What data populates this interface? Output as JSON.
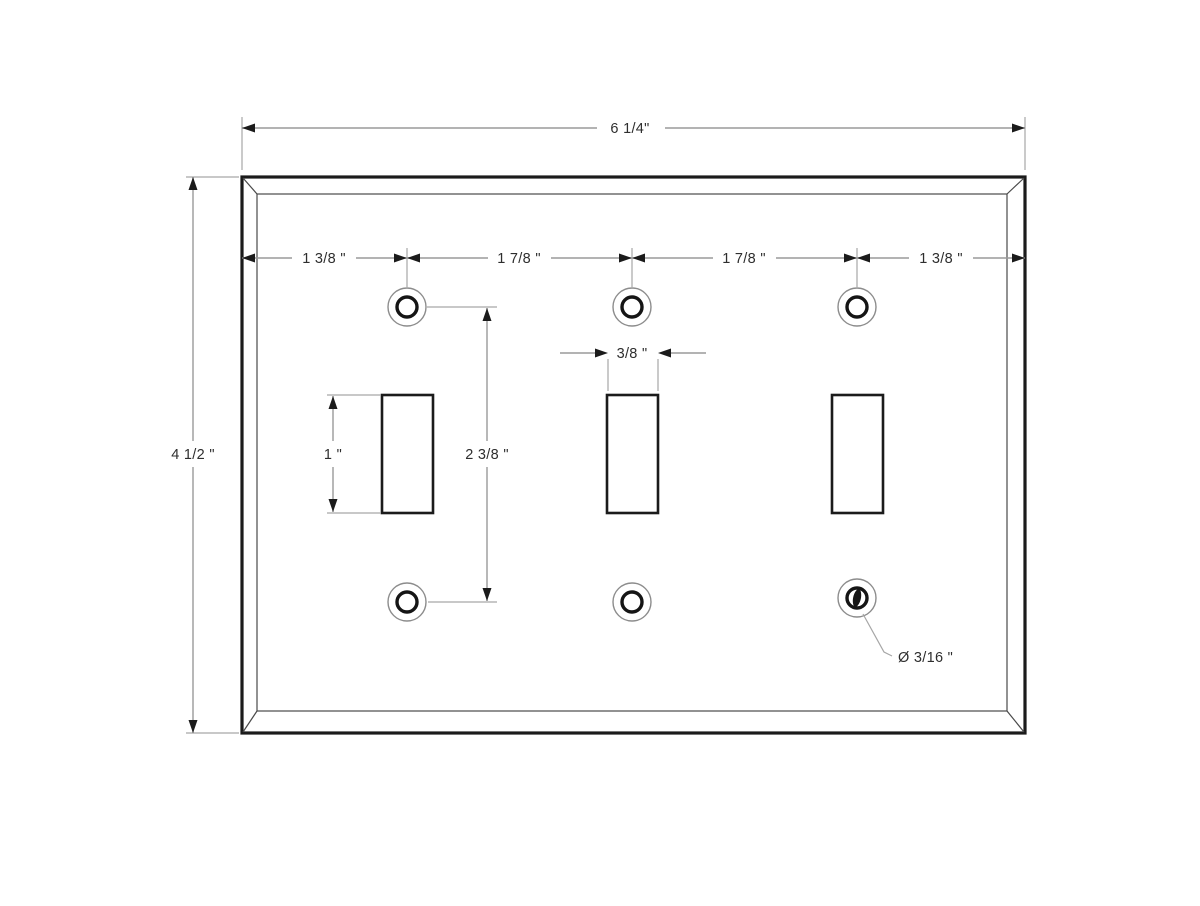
{
  "page": {
    "background_color": "#ffffff",
    "description": "Dimensioned technical drawing of a triple toggle switch wall plate"
  },
  "drawing": {
    "colors": {
      "outline": "#1b1b1b",
      "dimension_lines": "#9a9a9a",
      "text": "#2e2e2e"
    },
    "labels": {
      "overall_width": "6 1/4\"",
      "overall_height": "4 1/2 \"",
      "left_edge_to_hole": "1 3/8 \"",
      "hole_to_hole_1": "1 7/8 \"",
      "hole_to_hole_2": "1 7/8 \"",
      "hole_to_right_edge": "1 3/8 \"",
      "slot_width": "3/8 \"",
      "slot_height": "1 \"",
      "hole_vertical_spacing": "2 3/8 \"",
      "hole_diameter": "Ø 3/16 \""
    }
  }
}
